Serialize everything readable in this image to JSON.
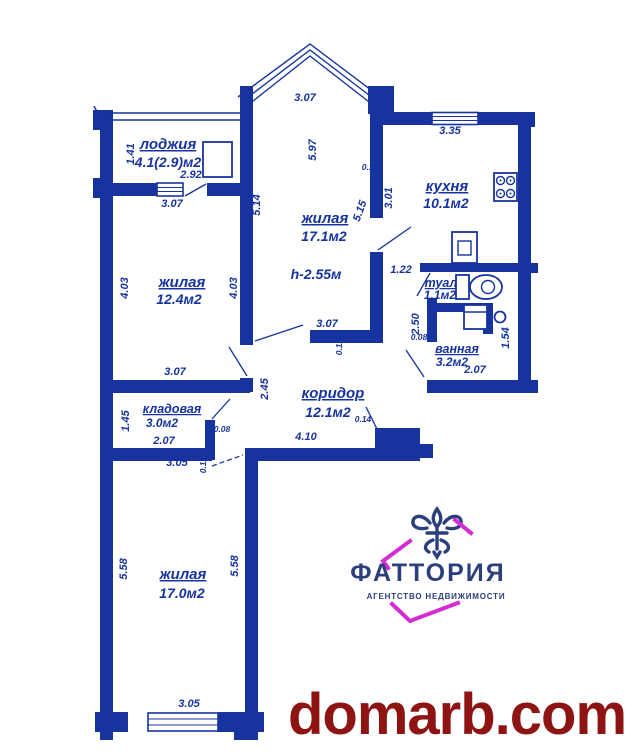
{
  "colors": {
    "wall_blue": "#17339f",
    "logo_navy": "#2c3f7d",
    "logo_magenta": "#d42bd4",
    "watermark_red": "#8e1414",
    "background": "#ffffff"
  },
  "rooms": {
    "loggia": {
      "name": "лоджия",
      "area": "4.1(2.9)м2"
    },
    "living_top": {
      "name": "жилая",
      "area": "17.1м2",
      "height_note": "h-2.55м"
    },
    "kitchen": {
      "name": "кухня",
      "area": "10.1м2"
    },
    "living_left": {
      "name": "жилая",
      "area": "12.4м2"
    },
    "toilet": {
      "name": "туал",
      "area": "1.1м2"
    },
    "bath": {
      "name": "ванная",
      "area": "3.2м2"
    },
    "corridor": {
      "name": "коридор",
      "area": "12.1м2"
    },
    "storage": {
      "name": "кладовая",
      "area": "3.0м2"
    },
    "living_bottom": {
      "name": "жилая",
      "area": "17.0м2"
    }
  },
  "dim": {
    "loggia_height": "1.41",
    "loggia_width": "2.92",
    "left_room_top": "3.07",
    "bay_width": "3.07",
    "top_room_height": "5.97",
    "top_room_left": "5.14",
    "wall_t_012a": "0.12",
    "top_room_right_a": "5.15",
    "top_room_right_b": "3.01",
    "kitchen_window": "3.35",
    "passage_width": "1.22",
    "left_room_left": "4.03",
    "left_room_right": "4.03",
    "left_room_bottom": "3.07",
    "top_room_bottom": "3.07",
    "wall_t_012b": "0.12",
    "toilet_height": "2.50",
    "wall_t_008a": "0.08",
    "bath_width": "2.07",
    "bath_niche": "1.54",
    "corridor_left_height": "2.45",
    "corridor_width": "4.10",
    "entry_width": "0.14",
    "wall_t_008b": "0.08",
    "storage_height": "1.45",
    "storage_width": "2.07",
    "storage_bottom": "3.05",
    "wall_t_012c": "0.12",
    "bottom_room_left": "5.58",
    "bottom_room_right": "5.58",
    "bottom_room_width": "3.05"
  },
  "icons": [
    "fleur-de-lis-icon",
    "stove-icon",
    "kitchen-sink-icon",
    "toilet-icon",
    "washer-icon",
    "washbasin-icon",
    "loggia-cabinet-icon"
  ],
  "logo": {
    "brand": "ФАТТОРИЯ",
    "tagline": "АГЕНТСТВО НЕДВИЖИМОСТИ"
  },
  "watermark": {
    "text": "domarb.com"
  }
}
